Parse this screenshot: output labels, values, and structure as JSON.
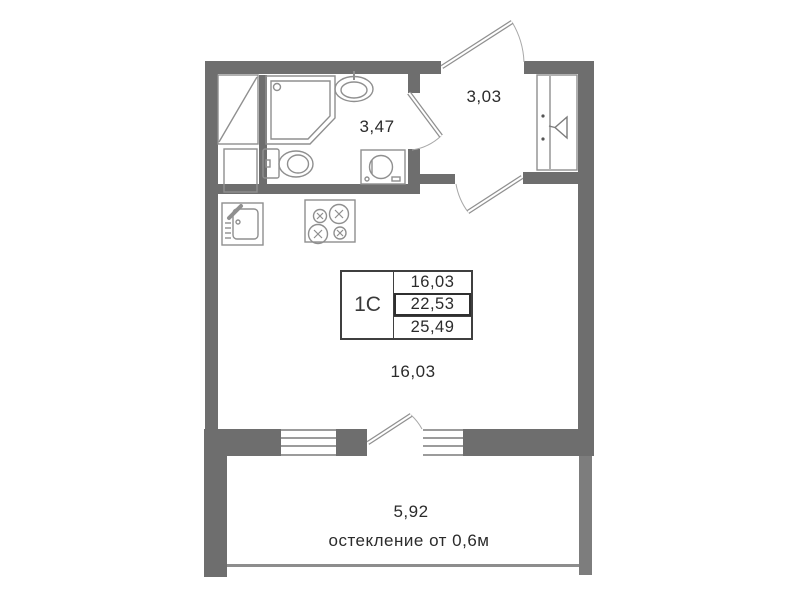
{
  "unit": {
    "type_label": "1С"
  },
  "area_table": {
    "rows": [
      {
        "value": "16,03"
      },
      {
        "value": "22,53"
      },
      {
        "value": "25,49"
      }
    ]
  },
  "rooms": {
    "bathroom": {
      "area": "3,47"
    },
    "hallway": {
      "area": "3,03"
    },
    "living": {
      "area": "16,03"
    },
    "balcony": {
      "area": "5,92",
      "glazing_note": "остекление от 0,6м"
    }
  },
  "fixtures": {
    "bathroom": [
      "shower-cabin",
      "washbasin",
      "toilet",
      "washing-machine"
    ],
    "kitchen": [
      "kitchen-sink",
      "stove-4-burner"
    ],
    "hallway": [
      "wardrobe-niche",
      "hanger"
    ],
    "storage": [
      "closet-with-diagonal"
    ],
    "openings": [
      "entrance-door",
      "bathroom-door",
      "room-door",
      "balcony-door",
      "window",
      "window"
    ]
  },
  "colors": {
    "wall": "#6e6e6e",
    "fixture_line": "#8f8f8f",
    "text": "#2b2b2b",
    "background": "#ffffff"
  }
}
